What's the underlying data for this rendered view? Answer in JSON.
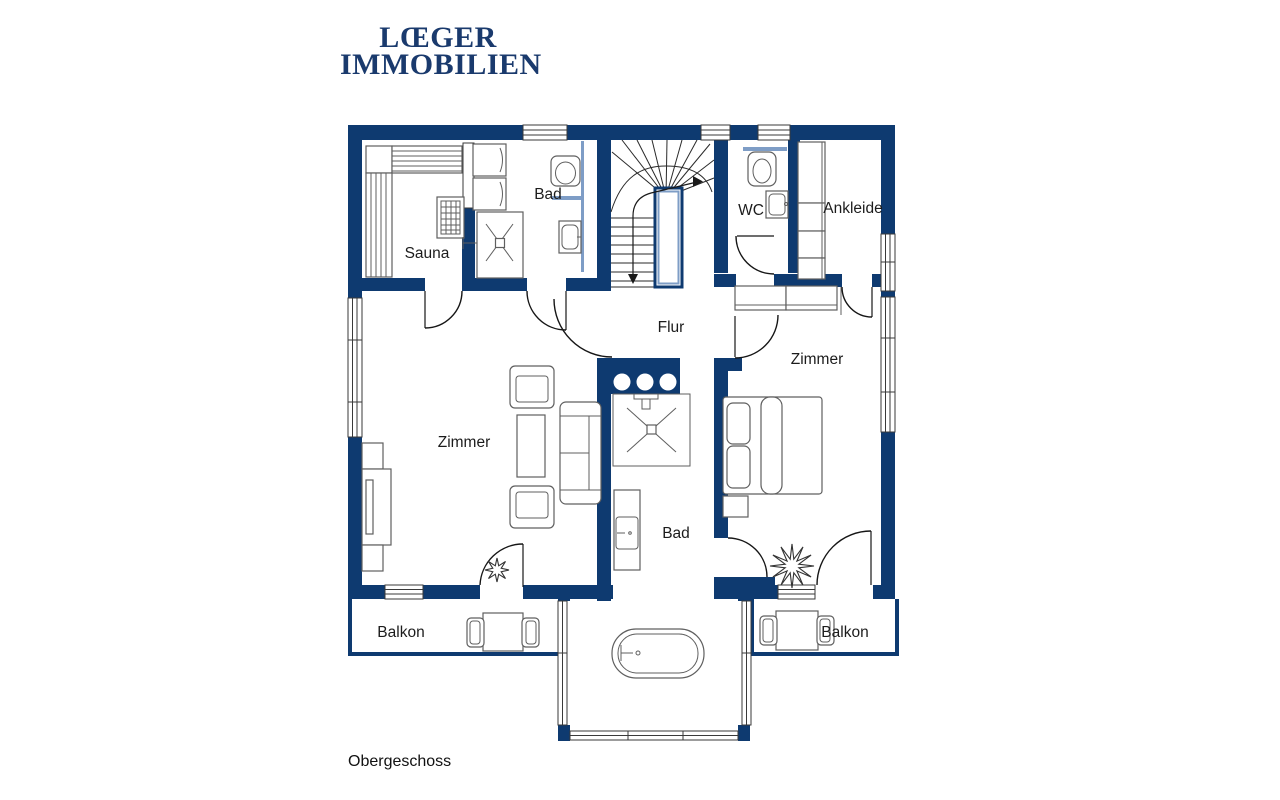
{
  "meta": {
    "floor_label": "Obergeschoss"
  },
  "logo": {
    "line1": "LŒGER",
    "line2": "IMMOBILIEN"
  },
  "colors": {
    "wall": "#0e3a70",
    "accent": "#7e9dc6",
    "logo": "#1a3a6d",
    "label": "#1c1c1c"
  },
  "rooms": [
    {
      "id": "sauna",
      "label": "Sauna"
    },
    {
      "id": "bad-top",
      "label": "Bad"
    },
    {
      "id": "wc",
      "label": "WC"
    },
    {
      "id": "ankleide",
      "label": "Ankleide"
    },
    {
      "id": "flur",
      "label": "Flur"
    },
    {
      "id": "zimmer-rechts",
      "label": "Zimmer"
    },
    {
      "id": "zimmer-links",
      "label": "Zimmer"
    },
    {
      "id": "bad-mitte",
      "label": "Bad"
    },
    {
      "id": "balkon-links",
      "label": "Balkon"
    },
    {
      "id": "balkon-rechts",
      "label": "Balkon"
    }
  ]
}
